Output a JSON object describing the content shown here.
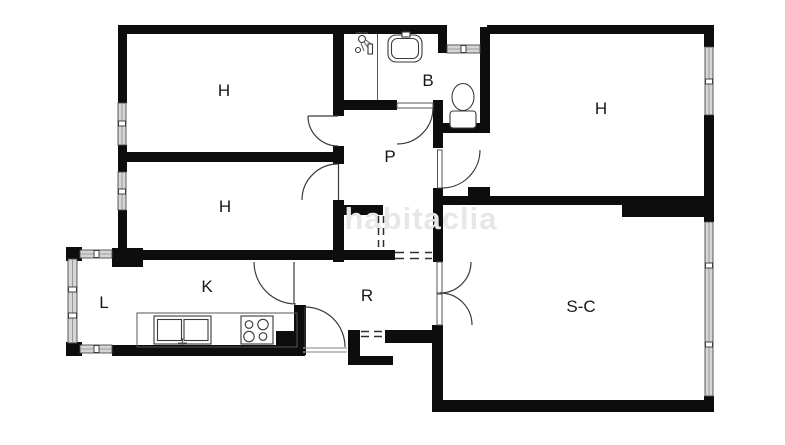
{
  "plan": {
    "watermark": "habitaclia",
    "rooms": [
      {
        "id": "bedroom-top-left",
        "label": "H"
      },
      {
        "id": "bathroom",
        "label": "B"
      },
      {
        "id": "bedroom-right",
        "label": "H"
      },
      {
        "id": "bedroom-mid-left",
        "label": "H"
      },
      {
        "id": "hallway",
        "label": "P"
      },
      {
        "id": "gallery-laundry",
        "label": "L"
      },
      {
        "id": "kitchen",
        "label": "K"
      },
      {
        "id": "entry-hall",
        "label": "R"
      },
      {
        "id": "living-dining",
        "label": "S-C"
      }
    ],
    "colors": {
      "background": "#ffffff",
      "wall": "#0d0d0d",
      "thin_line": "#3a3a3a",
      "window_fill": "#d6d6d6",
      "watermark": "#e7e7e7",
      "label": "#161616"
    }
  }
}
